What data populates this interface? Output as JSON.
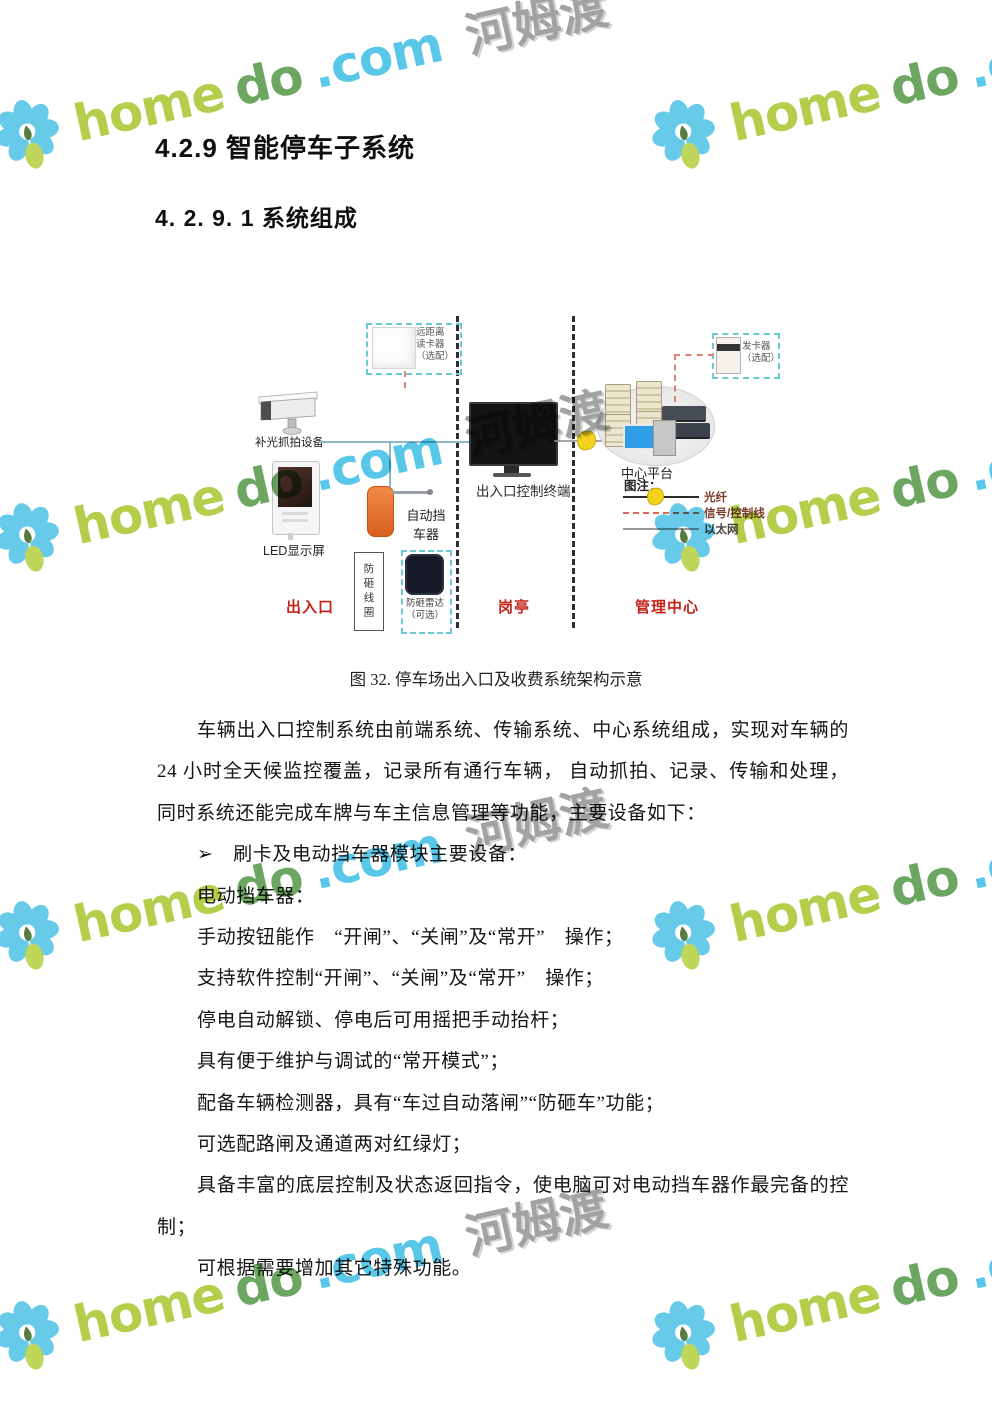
{
  "watermark": {
    "home": "home",
    "do": "do",
    "com": ".com",
    "cjk": "河姆渡",
    "colors": {
      "petal": "#5bc6e8",
      "leaf": "#b9d44c",
      "home": "#aeca3b",
      "do": "#5f9e53",
      "com": "#49c2e6",
      "cjk": "#9a9a9a"
    }
  },
  "headings": {
    "h1": "4.2.9  智能停车子系统",
    "h2": "4. 2. 9. 1  系统组成"
  },
  "figure": {
    "caption": "图 32. 停车场出入口及收费系统架构示意",
    "zones": {
      "entrance": "出入口",
      "booth": "岗亭",
      "center": "管理中心"
    },
    "camera_label": "补光抓拍设备",
    "led_label": "LED显示屏",
    "reader_label": "远距离\n读卡器\n（选配）",
    "barrier_label": "自动挡\n车器",
    "coil_label": "防砸线圈",
    "radar_label": "防砸雷达\n（可选）",
    "terminal_label": "出入口控制终端",
    "platform_label": "中心平台",
    "issuer_label": "发卡器\n（选配）",
    "legend_title": "图注：",
    "legend": [
      {
        "label": "光纤",
        "color": "#7c3a2c"
      },
      {
        "label": "信号/控制线",
        "color": "#7c3a2c"
      },
      {
        "label": "以太网",
        "color": "#4a443c"
      }
    ],
    "icons": {
      "lightning": "⚡"
    },
    "accent_colors": {
      "zone_red": "#c4231b",
      "teal_dash": "#6cc9d6",
      "barrier_orange": "#e8702a"
    }
  },
  "body": {
    "lines": [
      "车辆出入口控制系统由前端系统、传输系统、中心系统组成，实现对车辆的",
      "24 小时全天候监控覆盖，记录所有通行车辆， 自动抓拍、记录、传输和处理，",
      "同时系统还能完成车牌与车主信息管理等功能，主要设备如下：",
      "➢　刷卡及电动挡车器模块主要设备：",
      "电动挡车器：",
      "手动按钮能作　“开闸”、“关闸”及“常开”　操作；",
      "支持软件控制“开闸”、“关闸”及“常开”　操作；",
      "停电自动解锁、停电后可用摇把手动抬杆；",
      "具有便于维护与调试的“常开模式”；",
      "配备车辆检测器，具有“车过自动落闸”“防砸车”功能；",
      "可选配路闸及通道两对红绿灯；",
      "具备丰富的底层控制及状态返回指令，使电脑可对电动挡车器作最完备的控",
      "制；",
      "可根据需要增加其它特殊功能。"
    ]
  }
}
